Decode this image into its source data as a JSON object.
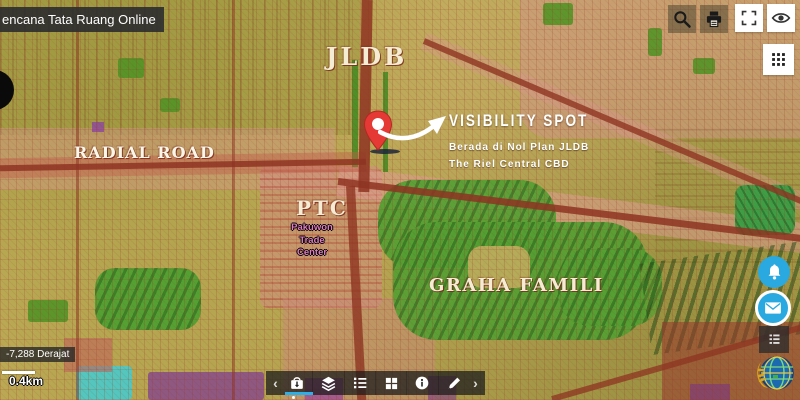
{
  "app": {
    "title_bar": "encana Tata Ruang Online"
  },
  "map_labels": {
    "jldb": "JLDB",
    "radial_road": "RADIAL ROAD",
    "visibility_spot": {
      "title": "VISIBILITY SPOT",
      "line1": "Berada di Nol Plan JLDB",
      "line2": "The Riel Central CBD"
    },
    "ptc": {
      "title": "PTC",
      "subtitle_lines": [
        "Pakuwon",
        "Trade",
        "Center"
      ]
    },
    "graha_famili": "GRAHA FAMILI"
  },
  "status": {
    "coordinates": "-7,288 Derajat",
    "scale": "0.4km"
  },
  "icons": {
    "top_buttons": [
      "search",
      "print",
      "fullscreen",
      "eye"
    ],
    "right_buttons": [
      "apps-grid",
      "notification-bell",
      "message-envelope",
      "legend-panel",
      "ministry-globe-logo"
    ],
    "bottom_toolbar": [
      "chevron-left",
      "basemap-bag",
      "layers",
      "legend-list",
      "grid",
      "info",
      "measure-pencil",
      "chevron-right"
    ],
    "chevron_left": "‹",
    "chevron_right": "›"
  },
  "colors": {
    "accent_blue": "#2aa9e0",
    "active_underline": "#2bb1e8",
    "pin_red": "#e53935",
    "map_green": "#55a033",
    "map_pink": "#d9a09a",
    "road_red": "#8e3422",
    "label_cream": "#f4ead2"
  }
}
